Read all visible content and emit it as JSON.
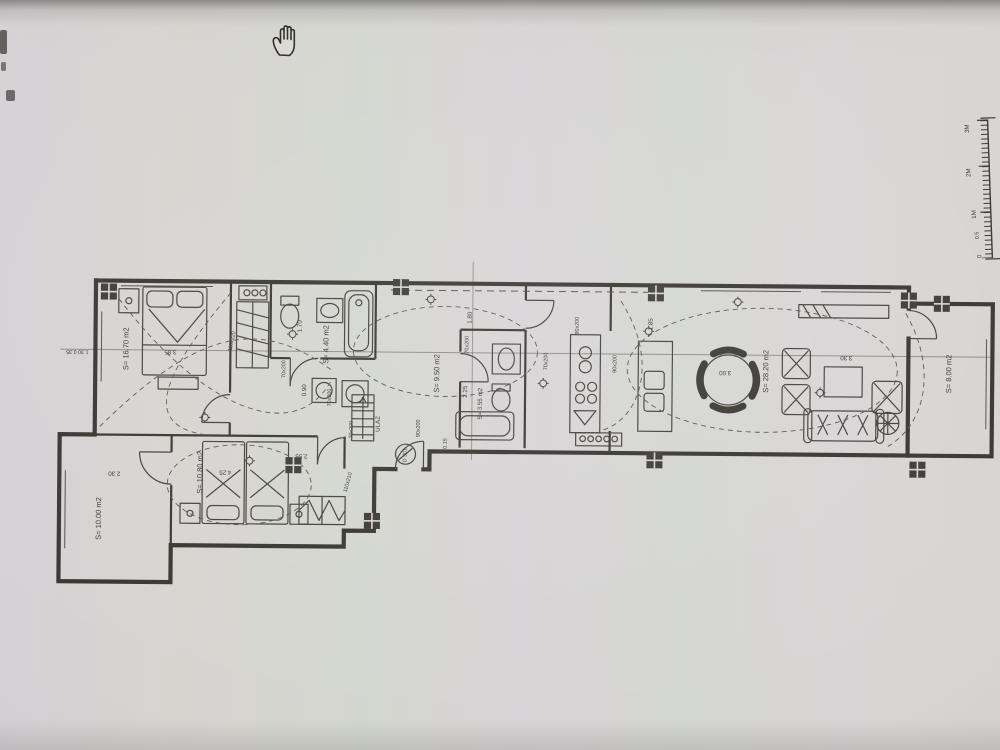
{
  "icons": {
    "cursor": "open-hand-pan-cursor"
  },
  "floorplan": {
    "rooms": {
      "bedroom1": "S= 16.70 m2",
      "bathroom1": "S= 4.40 m2",
      "hallway": "S= 9.50 m2",
      "bathroom2": "S= 3.55 m2",
      "living_dining": "S= 28.20 m2",
      "terrace_right": "S= 8.00 m2",
      "bedroom2": "S= 10.80 m2",
      "terrace_left": "S= 10.00 m2"
    },
    "entrance": {
      "label": "ULAZ",
      "door_code": "D 301",
      "door_size": "90x200"
    },
    "dims": {
      "bedroom1_width": "3.85",
      "bathroom1_length": "1.70",
      "wardrobe_top": "110x220",
      "door_bedroom1": "70x200",
      "hall_corner": "0.90",
      "door_bathroom1": "70x200",
      "door_bedroom2_w": "70x200",
      "hall_width": "1.80",
      "door_bathroom2": "70x200",
      "bathroom2_length": "2.25",
      "bathroom2_step": "0.15",
      "door_kitchen": "90x200",
      "door_kitchen2": "70x200",
      "kitchen_width": "1.85",
      "door_living": "90x200",
      "dining_width": "3.00",
      "living_width": "3.30",
      "bedroom2_length": "4.25",
      "bedroom2_width": "2.55",
      "wardrobe_bottom": "110x210",
      "terrace_left_width": "2.30",
      "wall_offsets": "1.30 0.35"
    },
    "scale_bar": {
      "m3": "3M",
      "m2": "2M",
      "m1": "1M",
      "m05": "0.5",
      "m0": "0"
    }
  }
}
